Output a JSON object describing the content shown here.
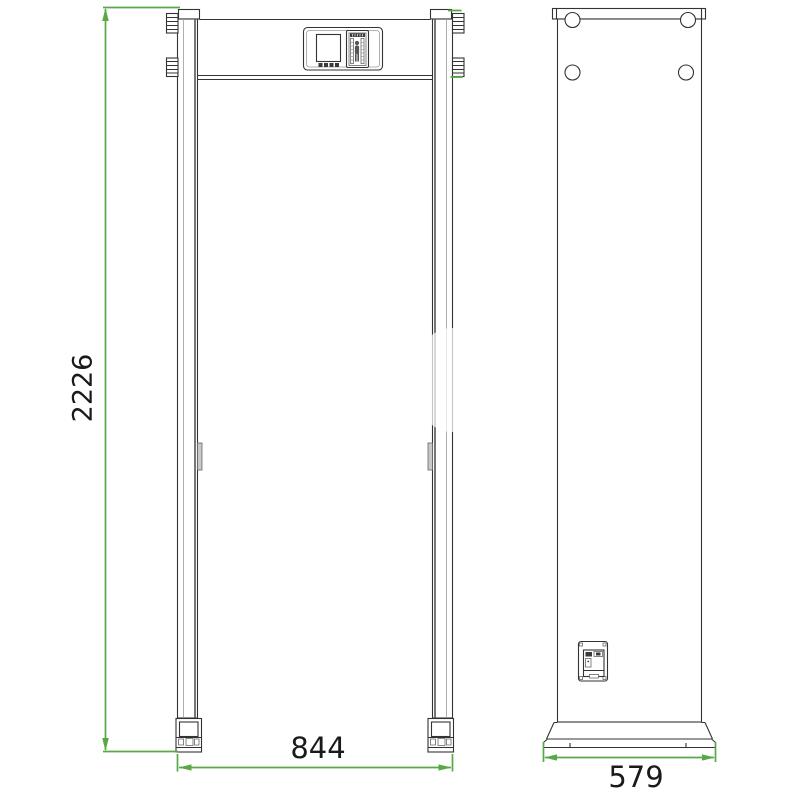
{
  "drawing": {
    "subject": "walk-through-metal-detector-dimensional-drawing",
    "front_view": {
      "dimension_height_label": "2226",
      "dimension_width_label": "844"
    },
    "side_view": {
      "dimension_depth_label": "579"
    },
    "icons": {
      "zone_person": "person-silhouette-icon",
      "bolt_hole": "circle-hole-icon"
    },
    "colors": {
      "outline": "#333333",
      "dimension_accent": "#56a945",
      "label_text": "#1a1a1a",
      "sensor_gray": "#c9c9c9"
    }
  }
}
